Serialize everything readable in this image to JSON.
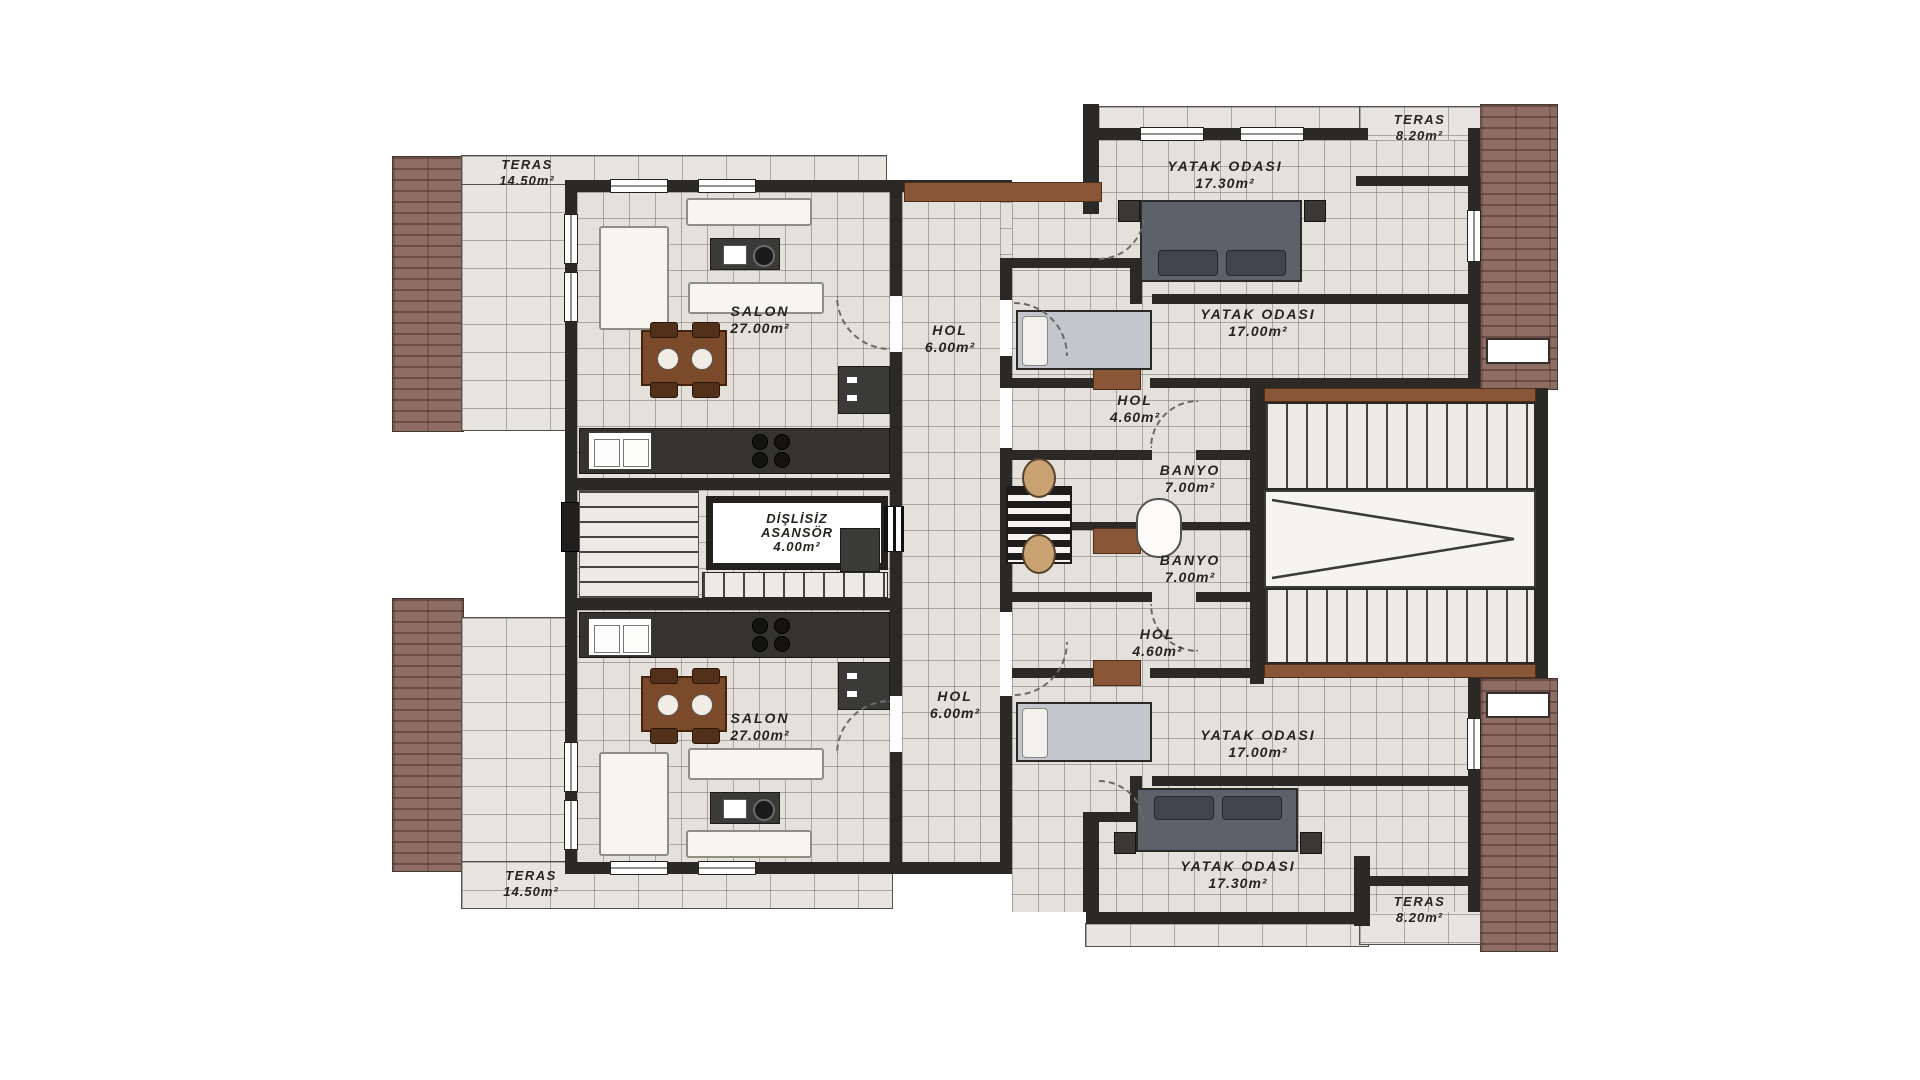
{
  "rooms": [
    {
      "id": "teras-nw",
      "name": "TERAS",
      "area": "14.50m²"
    },
    {
      "id": "salon-upper",
      "name": "SALON",
      "area": "27.00m²"
    },
    {
      "id": "hol-upper",
      "name": "HOL",
      "area": "6.00m²"
    },
    {
      "id": "yatak-odasi-1",
      "name": "YATAK ODASI",
      "area": "17.30m²"
    },
    {
      "id": "teras-ne",
      "name": "TERAS",
      "area": "8.20m²"
    },
    {
      "id": "yatak-odasi-2",
      "name": "YATAK ODASI",
      "area": "17.00m²"
    },
    {
      "id": "hol-kucuk-ust",
      "name": "HOL",
      "area": "4.60m²"
    },
    {
      "id": "banyo-ust",
      "name": "BANYO",
      "area": "7.00m²"
    },
    {
      "id": "asansor",
      "name": "DİŞLİSİZ ASANSÖR",
      "area": "4.00m²"
    },
    {
      "id": "banyo-alt",
      "name": "BANYO",
      "area": "7.00m²"
    },
    {
      "id": "hol-kucuk-alt",
      "name": "HOL",
      "area": "4.60m²"
    },
    {
      "id": "hol-lower",
      "name": "HOL",
      "area": "6.00m²"
    },
    {
      "id": "salon-lower",
      "name": "SALON",
      "area": "27.00m²"
    },
    {
      "id": "yatak-odasi-3",
      "name": "YATAK ODASI",
      "area": "17.00m²"
    },
    {
      "id": "yatak-odasi-4",
      "name": "YATAK ODASI",
      "area": "17.30m²"
    },
    {
      "id": "teras-sw",
      "name": "TERAS",
      "area": "14.50m²"
    },
    {
      "id": "teras-se",
      "name": "TERAS",
      "area": "8.20m²"
    }
  ],
  "colors": {
    "roof": "#8e6d65",
    "wall": "#2b2926",
    "tile": "#e4e1dc",
    "grid_line": "#6e6962",
    "wood": "#8a5638",
    "sofa": "#f7f5f0",
    "bed_dark": "#5c6069",
    "bed_light": "#c3c6cc",
    "fixture": "#c9a271",
    "background": "#ffffff"
  }
}
